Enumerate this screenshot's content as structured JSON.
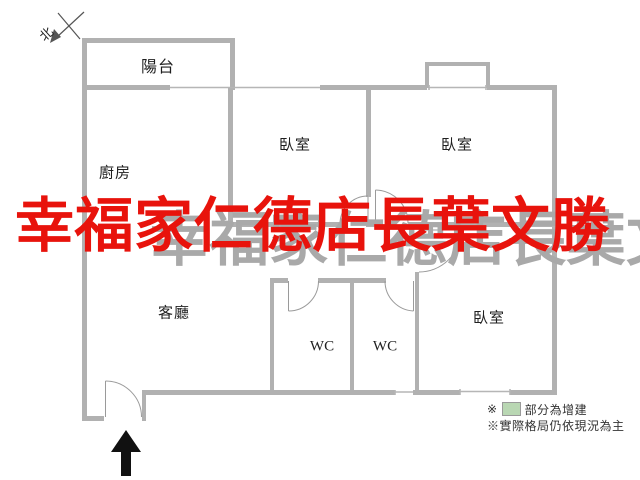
{
  "compass": {
    "north_label": "北"
  },
  "rooms": {
    "balcony": "陽台",
    "kitchen": "廚房",
    "bedroom_top_middle": "臥室",
    "bedroom_top_right": "臥室",
    "bedroom_bottom_right": "臥室",
    "living_room": "客廳",
    "wc_left": "WC",
    "wc_right": "WC"
  },
  "watermark": {
    "text": "幸福家仁德店長葉文勝",
    "color": "#e8130c",
    "echo_color": "#a9a9a9"
  },
  "legend": {
    "line1_prefix": "※",
    "line1_text": "部分為增建",
    "swatch_color": "#b9d7b3",
    "line2": "※實際格局仍依現況為主"
  },
  "colors": {
    "wall": "#b1b1b1",
    "thin_line": "#b6b6b6",
    "door_line": "#9a9a9a",
    "arrow": "#111111"
  }
}
